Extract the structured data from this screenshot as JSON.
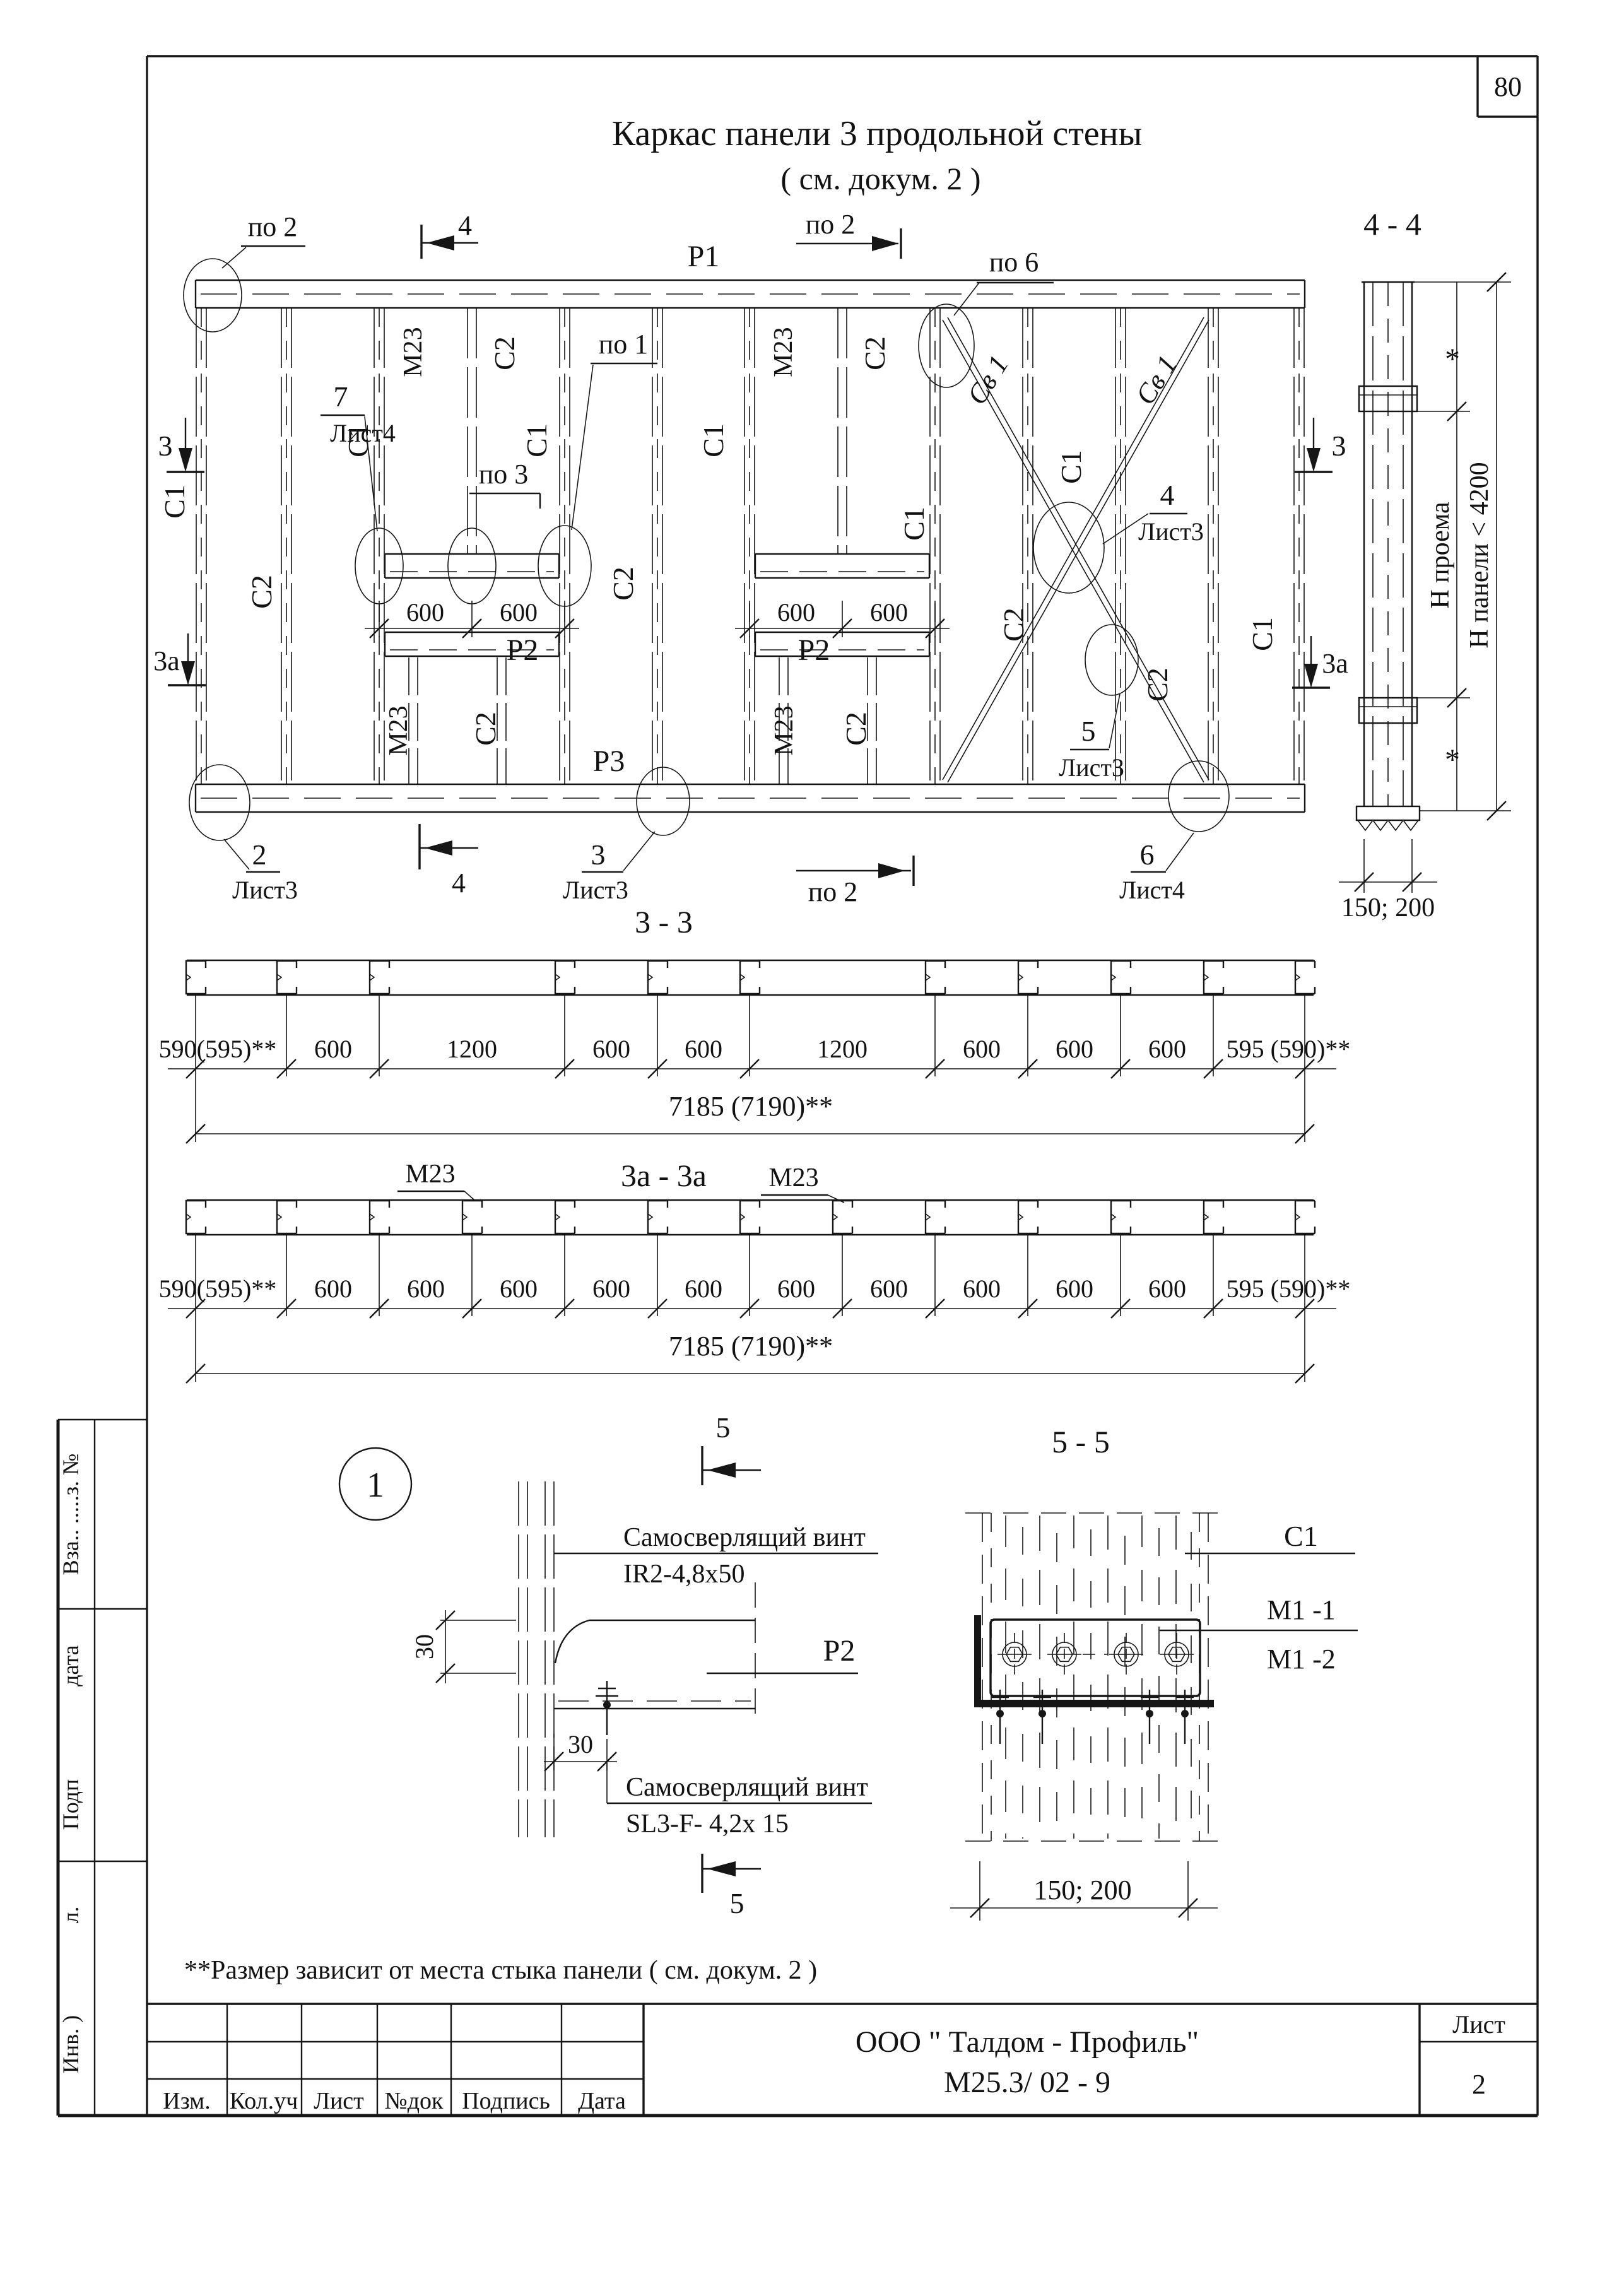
{
  "sheet": {
    "number": "80"
  },
  "title": {
    "line1": "Каркас  панели 3 продольной стены",
    "line2": "( см. докум. 2 )"
  },
  "plan": {
    "rail_top": "Р1",
    "rail_mid": "Р2",
    "rail_bottom": "Р3",
    "marker_po2": "по 2",
    "marker_po6": "по 6",
    "marker_po1": "по 1",
    "marker_po3": "по 3",
    "marker_4": "4",
    "marker_3": "3",
    "marker_3a": "3а",
    "node2": "2",
    "node3": "3",
    "node4": "4",
    "node5": "5",
    "node6": "6",
    "node7": "7",
    "sheet3": "Лист3",
    "sheet4": "Лист4",
    "stud_c1": "С1",
    "stud_c2": "С2",
    "m23": "М23",
    "brace": "Св 1",
    "dim600": "600"
  },
  "section44": {
    "title": "4 - 4",
    "dim_opening": "Н проема",
    "dim_panel": "Н панели < 4200",
    "asterisk": "*",
    "dim_width": "150; 200"
  },
  "section33": {
    "title": "3 - 3",
    "chain": [
      "590(595)**",
      "600",
      "1200",
      "600",
      "600",
      "1200",
      "600",
      "600",
      "600",
      "595 (590)**"
    ],
    "total": "7185 (7190)**"
  },
  "section3a": {
    "title": "3а - 3а",
    "m23": "М23",
    "chain": [
      "590(595)**",
      "600",
      "600",
      "600",
      "600",
      "600",
      "600",
      "600",
      "600",
      "600",
      "600",
      "595 (590)**"
    ],
    "total": "7185 (7190)**"
  },
  "detail1": {
    "bubble": "1",
    "marker5": "5",
    "screw_top_line1": "Самосверлящий винт",
    "screw_top_line2": "IR2-4,8х50",
    "label_p2": "Р2",
    "dim30": "30",
    "screw_bottom_line1": "Самосверлящий винт",
    "screw_bottom_line2": "SL3-F- 4,2х 15"
  },
  "section55": {
    "title": "5 - 5",
    "label_c1": "С1",
    "label_m1_1": "М1 -1",
    "label_m1_2": "М1 -2",
    "dim_width": "150; 200"
  },
  "note": "**Размер зависит от места стыка панели ( см. докум. 2 )",
  "stamp": {
    "cols": [
      "Изм.",
      "Кол.уч",
      "Лист",
      "№док",
      "Подпись",
      "Дата"
    ],
    "company": "ООО \" Талдом - Профиль\"",
    "doc_number": "М25.3/ 02 - 9",
    "sheet_label": "Лист",
    "sheet_number": "2"
  },
  "sidebar": {
    "vzam": "Вза.. .....з. №",
    "data": "дата",
    "podp": "Подп",
    "l": "л.",
    "inv": "Инв. )"
  }
}
